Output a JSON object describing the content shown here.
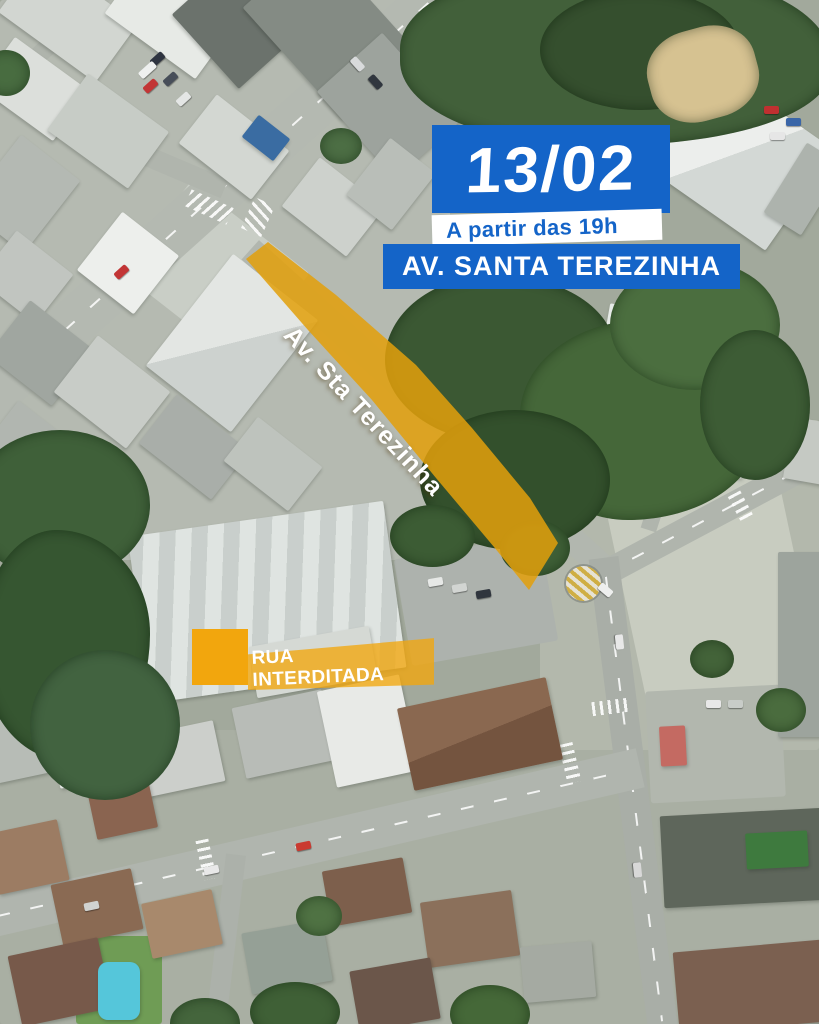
{
  "announcement": {
    "date": "13/02",
    "time_note": "A partir das 19h",
    "street_name": "AV. SANTA TEREZINHA"
  },
  "map": {
    "type": "aerial-satellite",
    "road_highlight_label": "Av. Sta Terezinha",
    "legend": {
      "label": "RUA INTERDITADA",
      "swatch_color": "#F2A60D"
    }
  },
  "theme": {
    "banner_blue": "#1464C8",
    "banner_text_white": "#FFFFFF",
    "highlight_orange": "#E2A00C",
    "legend_orange": "#F2A60D"
  }
}
